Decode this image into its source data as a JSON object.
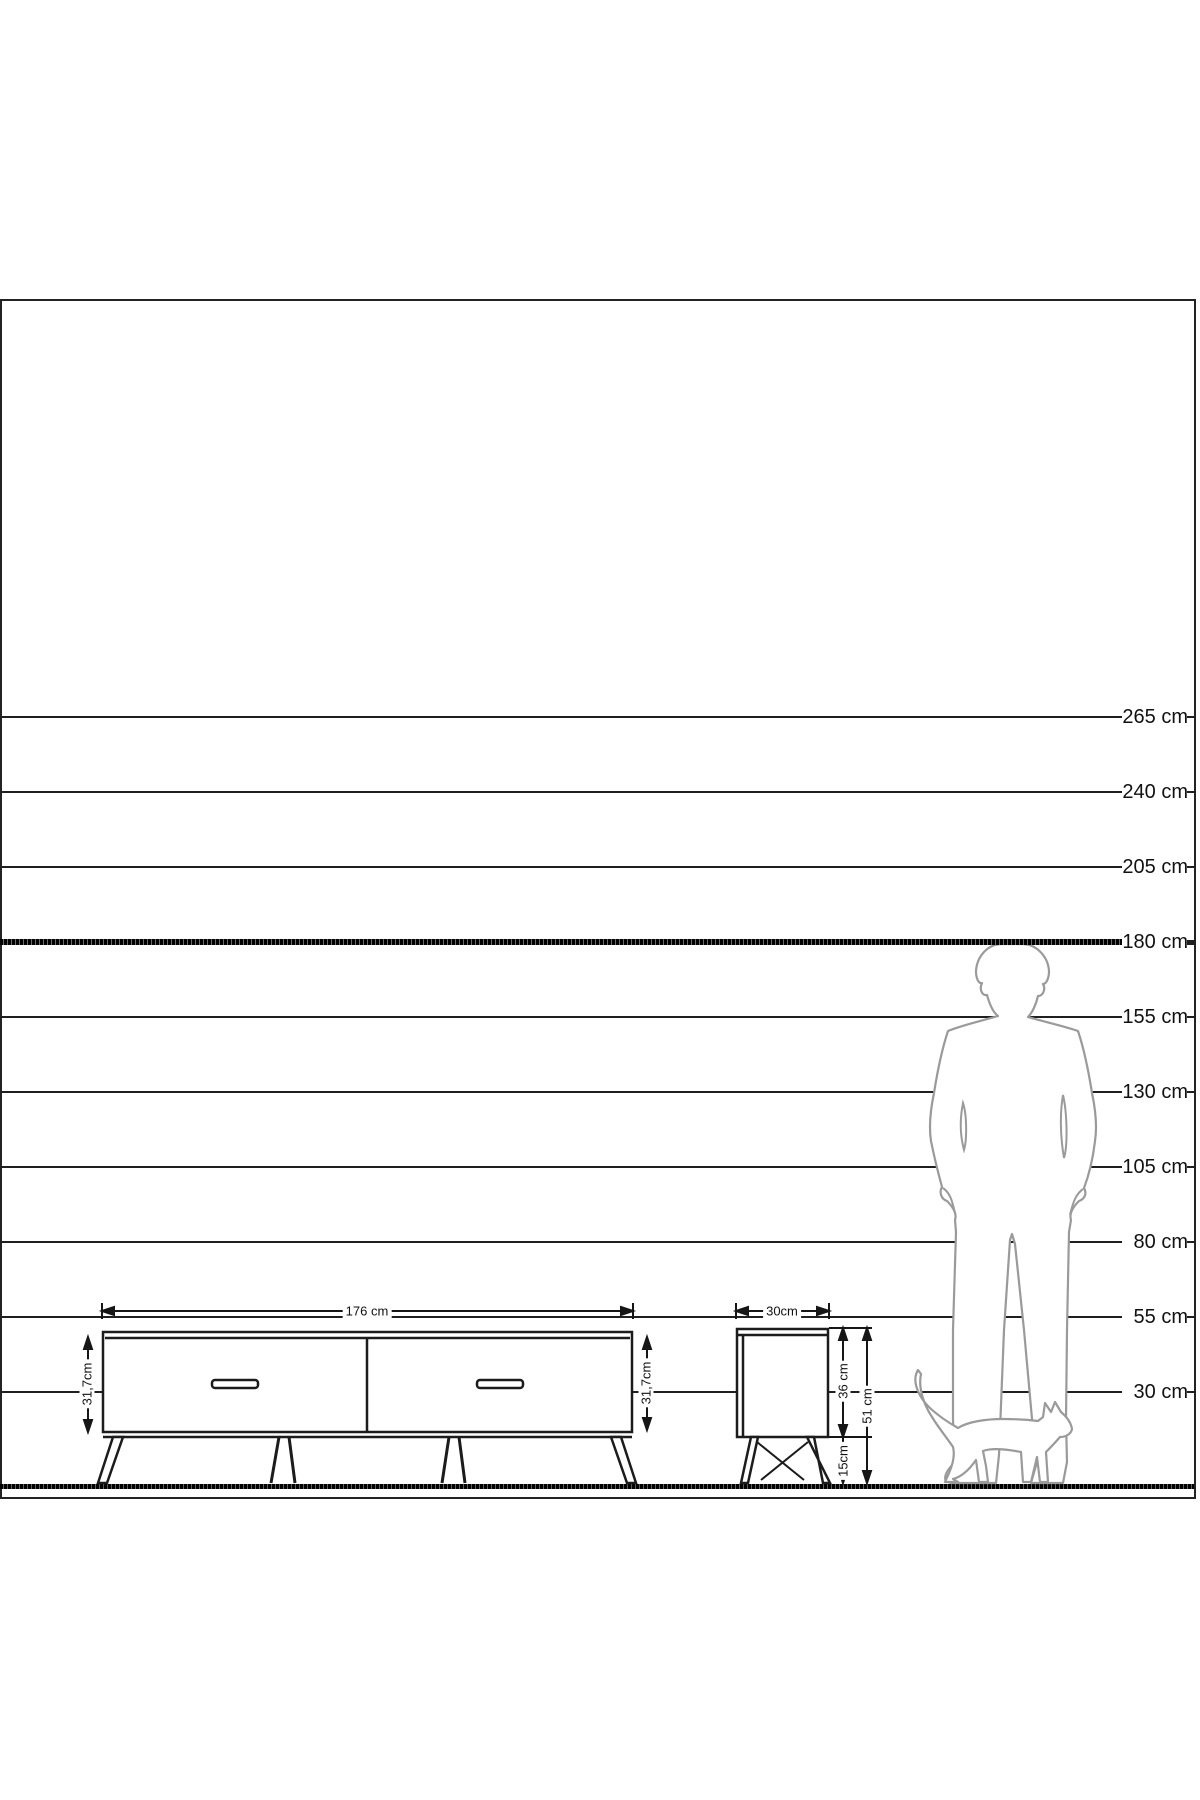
{
  "scale": {
    "unit": "cm",
    "labels": [
      "265 cm",
      "240 cm",
      "205 cm",
      "180 cm",
      "155 cm",
      "130 cm",
      "105 cm",
      "80 cm",
      "55 cm",
      "30 cm"
    ]
  },
  "tv_stand": {
    "width_label": "176 cm",
    "left_height_label": "31,7cm",
    "right_height_label": "31,7cm"
  },
  "side_table": {
    "width_label": "30cm",
    "body_height_label": "36 cm",
    "leg_height_label": "15cm",
    "total_height_label": "51 cm"
  },
  "figures": {
    "man": "standing-man-silhouette",
    "cat": "walking-cat-silhouette"
  },
  "colors": {
    "line": "#1f1f1f",
    "silhouette": "#9a9a9a",
    "background": "#ffffff"
  }
}
